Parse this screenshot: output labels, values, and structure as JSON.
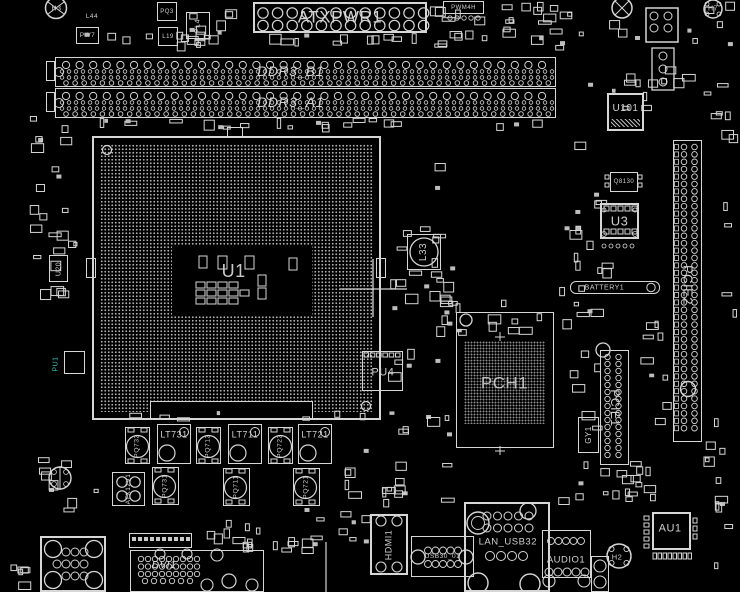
{
  "colors": {
    "background": "#000000",
    "outline": "#d6d6d6",
    "dim": "#9a9a9a",
    "teal": "#2fc8b8"
  },
  "refs": {
    "atxpwr1": "ATXPWR1",
    "ddr3_b1": "DDR3_B1",
    "ddr3_a1": "DDR3_A1",
    "cpu": "U1",
    "pch": "PCH1",
    "pcie1": "PCIE1",
    "pcie2": "PCIE2",
    "battery": "BATTERY1",
    "u101": "U101",
    "u3": "U3",
    "q8130": "Q8130",
    "pu4": "PU4",
    "pu1": "PU1",
    "u20": "U20",
    "l33": "L33",
    "l44": "L44",
    "l19": "L19",
    "pq3": "PQ3",
    "pw7": "PW7",
    "pl4": "PL4",
    "pwm4h": "PWM4H",
    "gy1": "GY1",
    "lt731": "LT731",
    "lt711": "LT711",
    "lt721": "LT721",
    "pq732": "PQ732",
    "pq712": "PQ712",
    "pq722": "PQ722",
    "pq731": "PQ731",
    "pq711": "PQ711",
    "pq721": "PQ721",
    "atx12v1": "ATX12V1",
    "au1": "AU1",
    "h2": "H2",
    "h3": "H3",
    "h7": "H7",
    "dvi1": "DVI1",
    "hdmi1": "HDMI1",
    "usb30": "USB30_01",
    "lan_usb": "LAN_USB32",
    "audio1": "AUDIO1"
  }
}
